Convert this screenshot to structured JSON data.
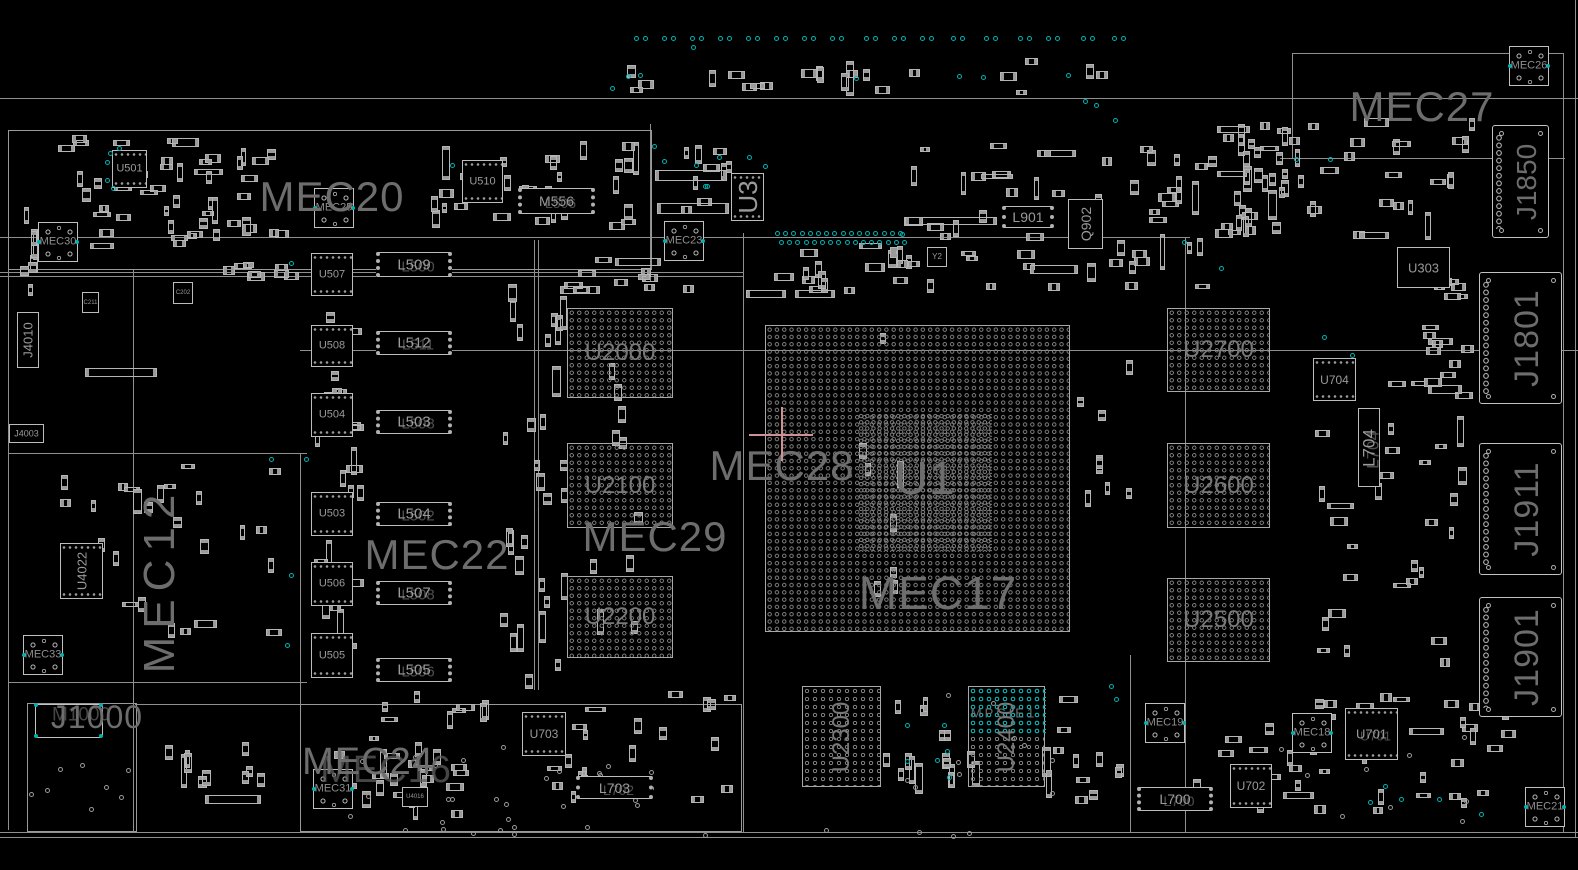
{
  "app": {
    "title": "Boardview"
  },
  "colors": {
    "bg": "#000000",
    "outline": "#b8b8b8",
    "line": "#8f8f8f",
    "text_big": "#6d6d6d",
    "text_small": "#9a9a9a",
    "teal": "#00b3b3",
    "crosshair": "#cf9191"
  },
  "region_labels": [
    {
      "text": "MEC20",
      "x": 332,
      "y": 197,
      "size": 42
    },
    {
      "text": "MEC27",
      "x": 1422,
      "y": 107,
      "size": 42
    },
    {
      "text": "MEC22",
      "x": 437,
      "y": 555,
      "size": 42
    },
    {
      "text": "MEC29",
      "x": 655,
      "y": 537,
      "size": 42
    },
    {
      "text": "MEC28",
      "x": 782,
      "y": 466,
      "size": 42
    },
    {
      "text": "U1",
      "x": 925,
      "y": 478,
      "size": 46
    },
    {
      "text": "MEC17",
      "x": 938,
      "y": 593,
      "size": 46
    },
    {
      "text": "MEC12",
      "x": 160,
      "y": 580,
      "size": 44,
      "rot": -90,
      "ls": 8
    },
    {
      "text": "MEC24",
      "x": 368,
      "y": 762,
      "size": 38,
      "ghost": "MEC16",
      "gdx": 18,
      "gdy": 8,
      "gsize": 38
    },
    {
      "text": "J1000",
      "x": 97,
      "y": 717,
      "size": 32,
      "ghost": "M1000",
      "gdx": -16,
      "gdy": -2,
      "gsize": 19
    },
    {
      "text": "MPCIE1",
      "x": 1004,
      "y": 713,
      "size": 13,
      "ls": 3
    }
  ],
  "bgas": [
    {
      "ref": "U2000",
      "x": 567,
      "y": 308,
      "w": 106,
      "h": 90,
      "fs": 24,
      "pitch": 7.5
    },
    {
      "ref": "U2100",
      "x": 567,
      "y": 443,
      "w": 106,
      "h": 85,
      "fs": 24,
      "pitch": 7.5
    },
    {
      "ref": "U2200",
      "x": 567,
      "y": 576,
      "w": 106,
      "h": 82,
      "fs": 24,
      "pitch": 7.5
    },
    {
      "ref": "U2700",
      "x": 1167,
      "y": 308,
      "w": 103,
      "h": 84,
      "fs": 24,
      "pitch": 7.5
    },
    {
      "ref": "U2600",
      "x": 1167,
      "y": 443,
      "w": 103,
      "h": 85,
      "fs": 24,
      "pitch": 7.5
    },
    {
      "ref": "U2500",
      "x": 1167,
      "y": 578,
      "w": 103,
      "h": 84,
      "fs": 24,
      "pitch": 7.5
    },
    {
      "ref": "U2300",
      "x": 802,
      "y": 686,
      "w": 79,
      "h": 101,
      "fs": 24,
      "pitch": 8,
      "rot": -90
    },
    {
      "ref": "U2400",
      "x": 968,
      "y": 686,
      "w": 77,
      "h": 101,
      "fs": 24,
      "pitch": 8,
      "rot": -90,
      "tealTop": 48
    },
    {
      "ref": "U1",
      "x": 765,
      "y": 325,
      "w": 305,
      "h": 307,
      "fs": 0,
      "pitch": 7.3,
      "nolabel": true
    },
    {
      "ref": "U1-core",
      "x": 858,
      "y": 413,
      "w": 134,
      "h": 139,
      "fs": 0,
      "pitch": 6.2,
      "nolabel": true,
      "noborder": true
    }
  ],
  "chips": [
    {
      "ref": "U501",
      "x": 112,
      "y": 150,
      "w": 35,
      "h": 38,
      "fs": 11,
      "type": "qfn"
    },
    {
      "ref": "U510",
      "x": 462,
      "y": 160,
      "w": 41,
      "h": 43,
      "fs": 11,
      "type": "qfn"
    },
    {
      "ref": "M556",
      "x": 518,
      "y": 188,
      "w": 77,
      "h": 26,
      "fs": 14,
      "type": "ind",
      "ghost": "L506"
    },
    {
      "ref": "U3",
      "x": 731,
      "y": 173,
      "w": 33,
      "h": 48,
      "fs": 26,
      "rot": -90,
      "type": "qfn"
    },
    {
      "ref": "U507",
      "x": 311,
      "y": 253,
      "w": 42,
      "h": 43,
      "fs": 11,
      "type": "qfn"
    },
    {
      "ref": "U508",
      "x": 311,
      "y": 325,
      "w": 42,
      "h": 42,
      "fs": 11,
      "type": "qfn"
    },
    {
      "ref": "U504",
      "x": 311,
      "y": 393,
      "w": 42,
      "h": 44,
      "fs": 11,
      "type": "qfn"
    },
    {
      "ref": "U503",
      "x": 311,
      "y": 492,
      "w": 42,
      "h": 44,
      "fs": 11,
      "type": "qfn"
    },
    {
      "ref": "U506",
      "x": 311,
      "y": 562,
      "w": 42,
      "h": 44,
      "fs": 11,
      "type": "qfn"
    },
    {
      "ref": "U505",
      "x": 311,
      "y": 633,
      "w": 42,
      "h": 45,
      "fs": 11,
      "type": "qfn"
    },
    {
      "ref": "L509",
      "x": 376,
      "y": 252,
      "w": 76,
      "h": 25,
      "fs": 15,
      "type": "ind",
      "ghost": "L500"
    },
    {
      "ref": "L512",
      "x": 376,
      "y": 331,
      "w": 76,
      "h": 24,
      "fs": 15,
      "type": "ind",
      "ghost": "L511"
    },
    {
      "ref": "L503",
      "x": 376,
      "y": 410,
      "w": 76,
      "h": 24,
      "fs": 15,
      "type": "ind",
      "ghost": "L508"
    },
    {
      "ref": "L504",
      "x": 376,
      "y": 502,
      "w": 76,
      "h": 24,
      "fs": 15,
      "type": "ind",
      "ghost": "L502"
    },
    {
      "ref": "L507",
      "x": 376,
      "y": 581,
      "w": 76,
      "h": 24,
      "fs": 15,
      "type": "ind",
      "ghost": "L508"
    },
    {
      "ref": "L505",
      "x": 376,
      "y": 658,
      "w": 76,
      "h": 24,
      "fs": 15,
      "type": "ind",
      "ghost": "L506"
    },
    {
      "ref": "L901",
      "x": 1002,
      "y": 206,
      "w": 52,
      "h": 22,
      "fs": 14,
      "type": "ind"
    },
    {
      "ref": "Q902",
      "x": 1068,
      "y": 199,
      "w": 35,
      "h": 50,
      "fs": 14,
      "rot": -90,
      "type": "plain"
    },
    {
      "ref": "Y2",
      "x": 927,
      "y": 247,
      "w": 20,
      "h": 20,
      "fs": 8,
      "type": "plain"
    },
    {
      "ref": "C211",
      "x": 82,
      "y": 292,
      "w": 17,
      "h": 21,
      "fs": 6,
      "type": "plain"
    },
    {
      "ref": "C202",
      "x": 173,
      "y": 282,
      "w": 20,
      "h": 22,
      "fs": 6,
      "type": "plain"
    },
    {
      "ref": "U303",
      "x": 1397,
      "y": 247,
      "w": 53,
      "h": 41,
      "fs": 13,
      "type": "plain"
    },
    {
      "ref": "U704",
      "x": 1313,
      "y": 358,
      "w": 43,
      "h": 43,
      "fs": 12,
      "type": "qfn"
    },
    {
      "ref": "L704",
      "x": 1358,
      "y": 408,
      "w": 22,
      "h": 79,
      "fs": 17,
      "rot": -90,
      "type": "plain",
      "ghost": "L704"
    },
    {
      "ref": "U703",
      "x": 522,
      "y": 712,
      "w": 44,
      "h": 44,
      "fs": 12,
      "type": "qfn"
    },
    {
      "ref": "L703",
      "x": 576,
      "y": 776,
      "w": 77,
      "h": 23,
      "fs": 14,
      "type": "ind",
      "ghost": "L702"
    },
    {
      "ref": "U702",
      "x": 1230,
      "y": 764,
      "w": 42,
      "h": 44,
      "fs": 12,
      "type": "qfn"
    },
    {
      "ref": "U701",
      "x": 1345,
      "y": 708,
      "w": 53,
      "h": 52,
      "fs": 13,
      "type": "qfn",
      "ghost": "U701"
    },
    {
      "ref": "L700",
      "x": 1137,
      "y": 787,
      "w": 76,
      "h": 24,
      "fs": 14,
      "type": "ind",
      "ghost": "L700"
    },
    {
      "ref": "U4022",
      "x": 60,
      "y": 543,
      "w": 43,
      "h": 56,
      "fs": 13,
      "rot": -90,
      "type": "qfn"
    },
    {
      "ref": "U4016",
      "x": 402,
      "y": 787,
      "w": 26,
      "h": 20,
      "fs": 6,
      "type": "plain"
    },
    {
      "ref": "J4003",
      "x": 9,
      "y": 424,
      "w": 35,
      "h": 19,
      "fs": 9,
      "type": "plain"
    },
    {
      "ref": "J4010",
      "x": 17,
      "y": 312,
      "w": 22,
      "h": 56,
      "fs": 13,
      "rot": -90,
      "type": "plain"
    }
  ],
  "mecs": [
    {
      "ref": "MEC30",
      "x": 38,
      "y": 222
    },
    {
      "ref": "MEC25",
      "x": 314,
      "y": 188
    },
    {
      "ref": "MEC23",
      "x": 664,
      "y": 221
    },
    {
      "ref": "MEC26",
      "x": 1509,
      "y": 46
    },
    {
      "ref": "MEC33",
      "x": 23,
      "y": 635
    },
    {
      "ref": "MEC31",
      "x": 313,
      "y": 769
    },
    {
      "ref": "MEC19",
      "x": 1145,
      "y": 703
    },
    {
      "ref": "MEC18",
      "x": 1292,
      "y": 713
    },
    {
      "ref": "MEC21",
      "x": 1525,
      "y": 787
    }
  ],
  "connectors": [
    {
      "ref": "J1850",
      "x": 1492,
      "y": 125,
      "w": 57,
      "h": 113,
      "fs": 28
    },
    {
      "ref": "J1801",
      "x": 1479,
      "y": 272,
      "w": 83,
      "h": 132,
      "fs": 34
    },
    {
      "ref": "J1911",
      "x": 1479,
      "y": 443,
      "w": 83,
      "h": 132,
      "fs": 34
    },
    {
      "ref": "J1901",
      "x": 1479,
      "y": 597,
      "w": 83,
      "h": 120,
      "fs": 34
    },
    {
      "ref": "J1000-pad",
      "x": 35,
      "y": 704,
      "w": 68,
      "h": 34,
      "fs": 0,
      "tealCorners": true,
      "nolabel": true,
      "nopins": true
    }
  ],
  "misc_rects": [
    [
      655,
      170,
      72,
      11
    ],
    [
      657,
      203,
      72,
      11
    ],
    [
      905,
      217,
      92,
      8
    ],
    [
      85,
      368,
      72,
      9
    ],
    [
      205,
      795,
      56,
      9
    ],
    [
      615,
      258,
      46,
      8
    ],
    [
      560,
      286,
      40,
      8
    ],
    [
      1030,
      265,
      48,
      9
    ],
    [
      746,
      290,
      40,
      8
    ],
    [
      795,
      290,
      40,
      8
    ]
  ],
  "lines": {
    "h": [
      [
        0,
        98,
        1578
      ],
      [
        0,
        237,
        1190
      ],
      [
        0,
        272,
        743
      ],
      [
        0,
        276,
        743
      ],
      [
        300,
        350,
        1278
      ],
      [
        8,
        453,
        299
      ],
      [
        8,
        682,
        299
      ],
      [
        135,
        704,
        605
      ],
      [
        1292,
        53,
        271
      ],
      [
        1280,
        158,
        285
      ],
      [
        0,
        832,
        1578
      ],
      [
        0,
        837,
        1578
      ]
    ],
    "v": [
      [
        8,
        130,
        700
      ],
      [
        133,
        270,
        562
      ],
      [
        300,
        453,
        379
      ],
      [
        650,
        124,
        158
      ],
      [
        534,
        240,
        450
      ],
      [
        538,
        240,
        450
      ],
      [
        743,
        233,
        599
      ],
      [
        1185,
        237,
        595
      ],
      [
        1130,
        655,
        177
      ],
      [
        1292,
        53,
        105
      ],
      [
        1563,
        53,
        779
      ],
      [
        1575,
        0,
        838
      ],
      [
        27,
        703,
        130
      ]
    ]
  },
  "boxes": [
    [
      8,
      130,
      642,
      138
    ],
    [
      27,
      703,
      108,
      127
    ],
    [
      300,
      704,
      440,
      126
    ]
  ],
  "teal": {
    "pair_y": 36,
    "pair_xs": [
      640,
      668,
      696,
      724,
      752,
      780,
      808,
      836,
      870,
      898,
      926,
      957,
      990,
      1024,
      1052,
      1087,
      1118
    ],
    "rows": [
      {
        "x": 775,
        "y": 231,
        "n": 16,
        "step": 8.2
      },
      {
        "x": 779,
        "y": 240,
        "n": 16,
        "step": 8.2
      }
    ],
    "scatter": [
      [
        108,
        151
      ],
      [
        117,
        146
      ],
      [
        105,
        160
      ],
      [
        105,
        178
      ],
      [
        111,
        186
      ],
      [
        289,
        261
      ],
      [
        450,
        163
      ],
      [
        652,
        144
      ],
      [
        662,
        159
      ],
      [
        694,
        163
      ],
      [
        703,
        184
      ],
      [
        717,
        155
      ],
      [
        747,
        155
      ],
      [
        763,
        164
      ],
      [
        705,
        184
      ],
      [
        626,
        74
      ],
      [
        638,
        73
      ],
      [
        854,
        76
      ],
      [
        957,
        74
      ],
      [
        981,
        75
      ],
      [
        1066,
        73
      ],
      [
        1083,
        99
      ],
      [
        1094,
        103
      ],
      [
        1113,
        118
      ],
      [
        900,
        232
      ],
      [
        1182,
        240
      ],
      [
        1219,
        266
      ],
      [
        1322,
        335
      ],
      [
        1350,
        353
      ],
      [
        269,
        457
      ],
      [
        304,
        457
      ],
      [
        289,
        573
      ],
      [
        285,
        643
      ],
      [
        1109,
        684
      ],
      [
        1114,
        697
      ],
      [
        905,
        723
      ],
      [
        942,
        723
      ],
      [
        905,
        759
      ],
      [
        935,
        758
      ],
      [
        945,
        749
      ],
      [
        947,
        775
      ],
      [
        1383,
        784
      ],
      [
        1368,
        800
      ],
      [
        1399,
        797
      ],
      [
        1437,
        797
      ],
      [
        1479,
        812
      ],
      [
        1294,
        157
      ],
      [
        1328,
        157
      ],
      [
        610,
        86
      ],
      [
        691,
        45
      ]
    ]
  },
  "crosshair": {
    "x": 781,
    "y": 434,
    "arm": 32
  },
  "decor": {
    "seed": 42,
    "passive_zones": [
      [
        40,
        135,
        250,
        115,
        48,
        0
      ],
      [
        200,
        255,
        100,
        30,
        8,
        1
      ],
      [
        313,
        295,
        55,
        380,
        26,
        0
      ],
      [
        430,
        140,
        210,
        95,
        30,
        0
      ],
      [
        500,
        280,
        70,
        410,
        30,
        2
      ],
      [
        560,
        255,
        140,
        40,
        10,
        1
      ],
      [
        755,
        235,
        170,
        60,
        18,
        0
      ],
      [
        900,
        140,
        320,
        155,
        55,
        0
      ],
      [
        1195,
        115,
        290,
        130,
        45,
        0
      ],
      [
        1420,
        275,
        55,
        125,
        16,
        1
      ],
      [
        1300,
        365,
        170,
        320,
        30,
        0
      ],
      [
        60,
        460,
        230,
        180,
        26,
        0
      ],
      [
        545,
        690,
        195,
        115,
        22,
        0
      ],
      [
        880,
        695,
        105,
        100,
        16,
        2
      ],
      [
        1040,
        695,
        85,
        115,
        12,
        0
      ],
      [
        1190,
        690,
        330,
        125,
        48,
        0
      ],
      [
        330,
        735,
        140,
        85,
        22,
        0
      ],
      [
        150,
        742,
        120,
        50,
        10,
        2
      ],
      [
        590,
        300,
        55,
        350,
        10,
        2
      ],
      [
        600,
        58,
        540,
        38,
        22,
        0
      ],
      [
        1235,
        120,
        60,
        120,
        14,
        2
      ],
      [
        680,
        140,
        60,
        100,
        10,
        0
      ],
      [
        20,
        190,
        20,
        120,
        8,
        2
      ],
      [
        855,
        300,
        60,
        330,
        8,
        2
      ],
      [
        1075,
        300,
        60,
        330,
        8,
        2
      ],
      [
        380,
        690,
        120,
        40,
        8,
        0
      ]
    ],
    "via_zones": [
      [
        335,
        740,
        330,
        95,
        26
      ],
      [
        25,
        750,
        115,
        75,
        8
      ],
      [
        895,
        685,
        170,
        110,
        10
      ],
      [
        1225,
        735,
        260,
        85,
        12
      ],
      [
        420,
        825,
        570,
        10,
        10
      ]
    ]
  }
}
